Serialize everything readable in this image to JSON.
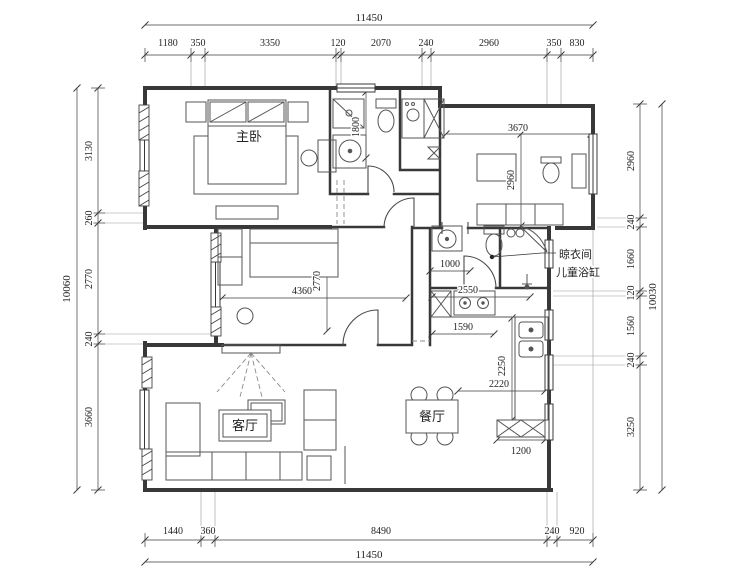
{
  "drawing": {
    "rooms": {
      "master_bedroom": "主卧",
      "living_room": "客厅",
      "dining_room": "餐厅"
    },
    "callout": {
      "line1": "晾衣间",
      "line2": "儿童浴缸"
    },
    "dims": {
      "top": {
        "total": "11450",
        "segs": [
          "1180",
          "350",
          "3350",
          "120",
          "2070",
          "240",
          "2960",
          "350",
          "830"
        ]
      },
      "bottom": {
        "total": "11450",
        "segs": [
          "1440",
          "360",
          "8490",
          "240",
          "920"
        ]
      },
      "left": {
        "total": "10060",
        "segs": [
          "3130",
          "260",
          "2770",
          "240",
          "3660"
        ]
      },
      "right": {
        "total": "10030",
        "segs": [
          "2960",
          "240",
          "1660",
          "120",
          "1560",
          "240",
          "3250"
        ]
      },
      "interior": {
        "bath_depth": "1800",
        "child_width": "3670",
        "child_depth": "2960",
        "vanity_width": "1000",
        "bed2_width": "4360",
        "bed2_depth": "2770",
        "kitchen_width": "2550",
        "counter_width": "1590",
        "kitchen_depth": "2250",
        "dining_width": "2220",
        "cabinet_width": "1200"
      }
    },
    "colors": {
      "wall": "#383838",
      "furniture": "#555555",
      "dim": "#3c3c3c",
      "background": "#ffffff"
    }
  }
}
